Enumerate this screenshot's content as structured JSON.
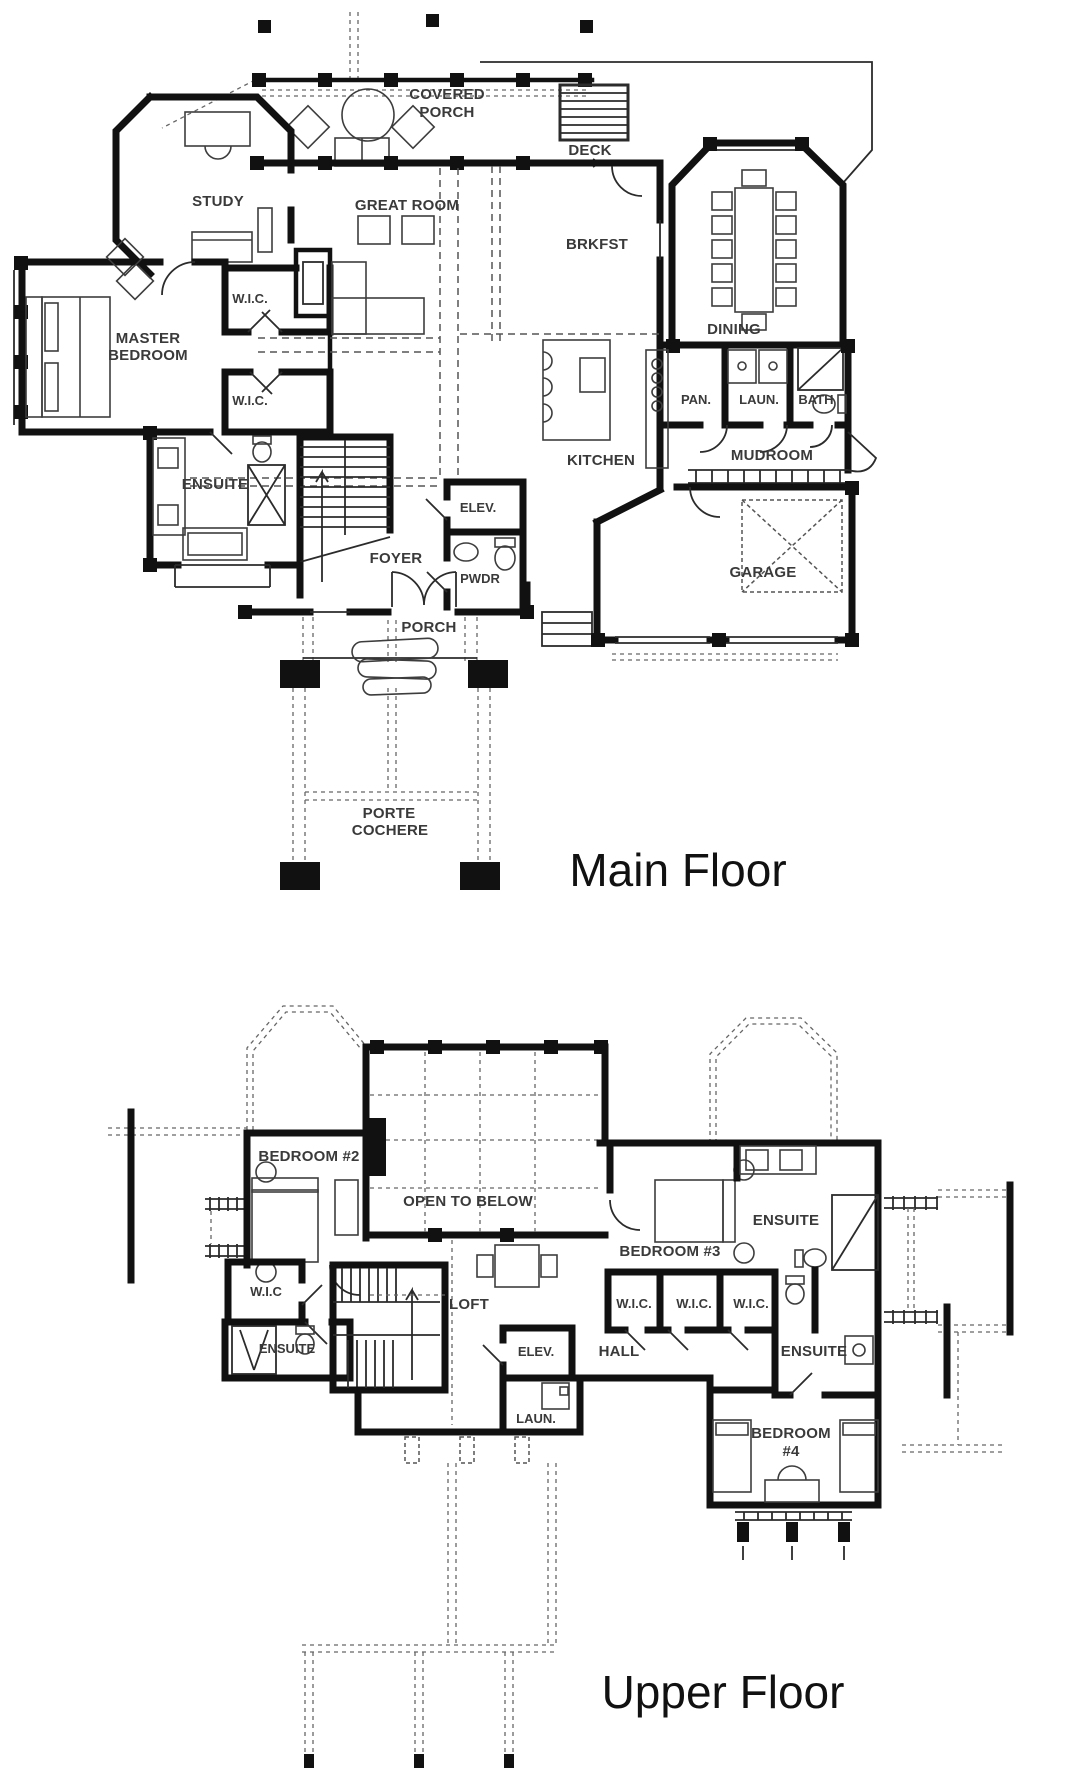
{
  "colors": {
    "background": "#ffffff",
    "walls": "#111111",
    "label_text": "#3a3a3a",
    "dashed_lines": "#555555"
  },
  "main_floor": {
    "title": "Main Floor",
    "labels": {
      "covered": "COVERED",
      "covered2": "PORCH",
      "deck": "DECK",
      "study": "STUDY",
      "great_room": "GREAT ROOM",
      "brkfst": "BRKFST",
      "dining": "DINING",
      "master1": "MASTER",
      "master2": "BEDROOM",
      "wic_a": "W.I.C.",
      "wic_b": "W.I.C.",
      "pan": "PAN.",
      "laun": "LAUN.",
      "bath": "BATH",
      "mudroom": "MUDROOM",
      "kitchen": "KITCHEN",
      "elev": "ELEV.",
      "foyer": "FOYER",
      "pwdr": "PWDR",
      "ensuite": "ENSUITE",
      "garage": "GARAGE",
      "porch": "PORCH",
      "porte1": "PORTE",
      "porte2": "COCHERE"
    }
  },
  "upper_floor": {
    "title": "Upper Floor",
    "labels": {
      "bedroom2": "BEDROOM #2",
      "open_below": "OPEN TO BELOW",
      "wic_left": "W.I.C",
      "ensuite_left": "ENSUITE",
      "loft": "LOFT",
      "elev": "ELEV.",
      "laun": "LAUN.",
      "hall": "HALL",
      "bedroom3": "BEDROOM #3",
      "wic1": "W.I.C.",
      "wic2": "W.I.C.",
      "wic3": "W.I.C.",
      "ensuite_right_top": "ENSUITE",
      "ensuite_right_mid": "ENSUITE",
      "bedroom4_1": "BEDROOM",
      "bedroom4_2": "#4"
    }
  }
}
